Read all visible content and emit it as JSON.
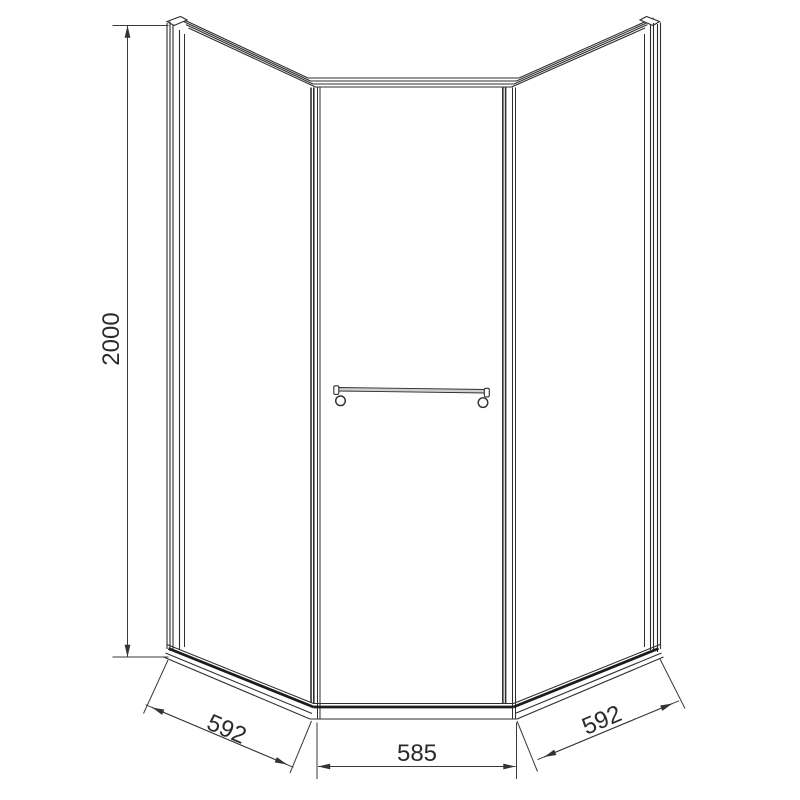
{
  "drawing": {
    "labels": {
      "height": "2000",
      "left_width": "592",
      "front_width": "585",
      "right_width": "592"
    },
    "colors": {
      "background": "#ffffff",
      "frame_line": "#2e2e2e",
      "dimension_line": "#3a3a3a",
      "towel_bar_fill": "#cfcfcf"
    }
  }
}
